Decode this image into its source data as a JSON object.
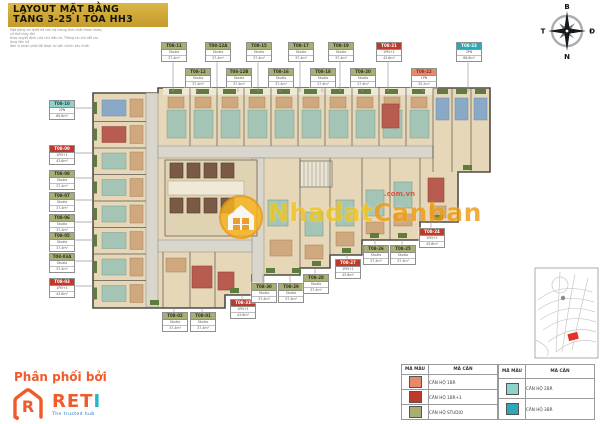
{
  "title": {
    "line1": "LAYOUT MẶT BẰNG",
    "line2": "TẦNG 3-25 I TÒA HH3"
  },
  "disclaimer": {
    "line1": "Mặt bằng và thiết kế căn hộ mang tính chất tham khảo, có thể thay đổi",
    "line2": "theo quyết định của chủ đầu tư. Thông tin chi tiết vui lòng liên hệ",
    "line3": "đơn vị phân phối để được tư vấn chính xác nhất."
  },
  "compass": {
    "north": "B",
    "south": "N",
    "west": "T",
    "east": "Đ"
  },
  "watermark": {
    "brand_part1": "Nhadat",
    "brand_part2": "Canban",
    "domain": ".com.vn"
  },
  "distributor": {
    "heading": "Phân phối bởi",
    "brand_main": "RET",
    "brand_accent": "I",
    "tagline": "The trusted hub"
  },
  "colors": {
    "studio": "#A9AE72",
    "one_br": "#E9896C",
    "one_br_plus": "#C03A2B",
    "two_br": "#8FD2C9",
    "three_br": "#2AA9B8",
    "title_gold": "#C9A22F",
    "reti_orange": "#F15A29",
    "watermark_yellow": "#F2C41C",
    "watermark_orange": "#EF9D13",
    "map_highlight_red": "#E53126"
  },
  "legend": {
    "headers": [
      "MÃ MÀU",
      "MÃ CĂN"
    ],
    "left_rows": [
      {
        "type_key": "one_br",
        "label": "CĂN HỘ 1BR"
      },
      {
        "type_key": "one_br_plus",
        "label": "CĂN HỘ 1BR+1"
      },
      {
        "type_key": "studio",
        "label": "CĂN HỘ STUDIO"
      }
    ],
    "right_rows": [
      {
        "type_key": "two_br",
        "label": "CĂN HỘ 2BR"
      },
      {
        "type_key": "three_br",
        "label": "CĂN HỘ 3BR"
      }
    ]
  },
  "plan": {
    "units": [
      {
        "code": "T08-11",
        "type_key": "studio",
        "line1": "Studio",
        "line2": "37.4m²",
        "side": "top",
        "x": 173,
        "y": 42,
        "t": 92
      },
      {
        "code": "T08-12",
        "type_key": "studio",
        "line1": "Studio",
        "line2": "37.4m²",
        "side": "top",
        "x": 197,
        "y": 68,
        "t": 92
      },
      {
        "code": "T08-12A",
        "type_key": "studio",
        "line1": "Studio",
        "line2": "37.4m²",
        "side": "top",
        "x": 217,
        "y": 42,
        "t": 92
      },
      {
        "code": "T08-12B",
        "type_key": "studio",
        "line1": "Studio",
        "line2": "37.4m²",
        "side": "top",
        "x": 238,
        "y": 68,
        "t": 92
      },
      {
        "code": "T08-15",
        "type_key": "studio",
        "line1": "Studio",
        "line2": "37.4m²",
        "side": "top",
        "x": 258,
        "y": 42,
        "t": 92
      },
      {
        "code": "T08-16",
        "type_key": "studio",
        "line1": "Studio",
        "line2": "37.4m²",
        "side": "top",
        "x": 280,
        "y": 68,
        "t": 92
      },
      {
        "code": "T08-17",
        "type_key": "studio",
        "line1": "Studio",
        "line2": "37.4m²",
        "side": "top",
        "x": 300,
        "y": 42,
        "t": 92
      },
      {
        "code": "T08-18",
        "type_key": "studio",
        "line1": "Studio",
        "line2": "37.4m²",
        "side": "top",
        "x": 322,
        "y": 68,
        "t": 92
      },
      {
        "code": "T08-19",
        "type_key": "studio",
        "line1": "Studio",
        "line2": "37.4m²",
        "side": "top",
        "x": 340,
        "y": 42,
        "t": 92
      },
      {
        "code": "T08-20",
        "type_key": "studio",
        "line1": "Studio",
        "line2": "37.4m²",
        "side": "top",
        "x": 362,
        "y": 68,
        "t": 92
      },
      {
        "code": "T08-21",
        "type_key": "one_br_plus",
        "line1": "1PN+1",
        "line2": "43.6m²",
        "side": "top",
        "x": 388,
        "y": 42,
        "t": 92
      },
      {
        "code": "T08-22",
        "type_key": "one_br",
        "line1": "1PN",
        "line2": "35.2m²",
        "side": "top",
        "x": 423,
        "y": 68,
        "t": 92
      },
      {
        "code": "T08-23",
        "type_key": "three_br",
        "line1": "3PN",
        "line2": "88.6m²",
        "side": "top",
        "x": 468,
        "y": 42,
        "t": 92
      },
      {
        "code": "T08-10",
        "type_key": "two_br",
        "line1": "2PN",
        "line2": "69.8m²",
        "side": "left",
        "x": 61,
        "y": 100,
        "t": 93
      },
      {
        "code": "T08-09",
        "type_key": "one_br_plus",
        "line1": "1PN+1",
        "line2": "43.6m²",
        "side": "left",
        "x": 61,
        "y": 145,
        "t": 93
      },
      {
        "code": "T08-08",
        "type_key": "studio",
        "line1": "Studio",
        "line2": "37.4m²",
        "side": "left",
        "x": 61,
        "y": 170,
        "t": 93
      },
      {
        "code": "T08-07",
        "type_key": "studio",
        "line1": "Studio",
        "line2": "37.4m²",
        "side": "left",
        "x": 61,
        "y": 192,
        "t": 93
      },
      {
        "code": "T08-06",
        "type_key": "studio",
        "line1": "Studio",
        "line2": "37.4m²",
        "side": "left",
        "x": 61,
        "y": 214,
        "t": 93
      },
      {
        "code": "T08-05",
        "type_key": "studio",
        "line1": "Studio",
        "line2": "37.4m²",
        "side": "left",
        "x": 61,
        "y": 232,
        "t": 93
      },
      {
        "code": "T08-03A",
        "type_key": "studio",
        "line1": "Studio",
        "line2": "37.4m²",
        "side": "left",
        "x": 61,
        "y": 253,
        "t": 93
      },
      {
        "code": "T08-03",
        "type_key": "one_br_plus",
        "line1": "1PN+1",
        "line2": "43.6m²",
        "side": "left",
        "x": 61,
        "y": 278,
        "t": 93
      },
      {
        "code": "T08-02",
        "type_key": "studio",
        "line1": "Studio",
        "line2": "37.4m²",
        "side": "bottom",
        "x": 174,
        "y": 312,
        "t": 308
      },
      {
        "code": "T08-01",
        "type_key": "studio",
        "line1": "Studio",
        "line2": "37.4m²",
        "side": "bottom",
        "x": 202,
        "y": 312,
        "t": 308
      },
      {
        "code": "T08-31",
        "type_key": "one_br_plus",
        "line1": "1PN+1",
        "line2": "43.6m²",
        "side": "bottom",
        "x": 242,
        "y": 299,
        "t": 295
      },
      {
        "code": "T08-30",
        "type_key": "studio",
        "line1": "Studio",
        "line2": "37.4m²",
        "side": "bottom",
        "x": 263,
        "y": 283,
        "t": 275
      },
      {
        "code": "T08-29",
        "type_key": "studio",
        "line1": "Studio",
        "line2": "37.4m²",
        "side": "bottom",
        "x": 290,
        "y": 283,
        "t": 275
      },
      {
        "code": "T08-28",
        "type_key": "studio",
        "line1": "Studio",
        "line2": "37.4m²",
        "side": "bottom",
        "x": 315,
        "y": 274,
        "t": 268
      },
      {
        "code": "T08-27",
        "type_key": "one_br_plus",
        "line1": "1PN+1",
        "line2": "43.6m²",
        "side": "bottom",
        "x": 347,
        "y": 259,
        "t": 255
      },
      {
        "code": "T08-26",
        "type_key": "studio",
        "line1": "Studio",
        "line2": "37.4m²",
        "side": "bottom",
        "x": 375,
        "y": 245,
        "t": 240
      },
      {
        "code": "T08-25",
        "type_key": "studio",
        "line1": "Studio",
        "line2": "37.4m²",
        "side": "bottom",
        "x": 402,
        "y": 245,
        "t": 240
      },
      {
        "code": "T08-24",
        "type_key": "one_br_plus",
        "line1": "1PN+1",
        "line2": "43.6m²",
        "side": "bottom",
        "x": 431,
        "y": 228,
        "t": 222
      }
    ]
  }
}
